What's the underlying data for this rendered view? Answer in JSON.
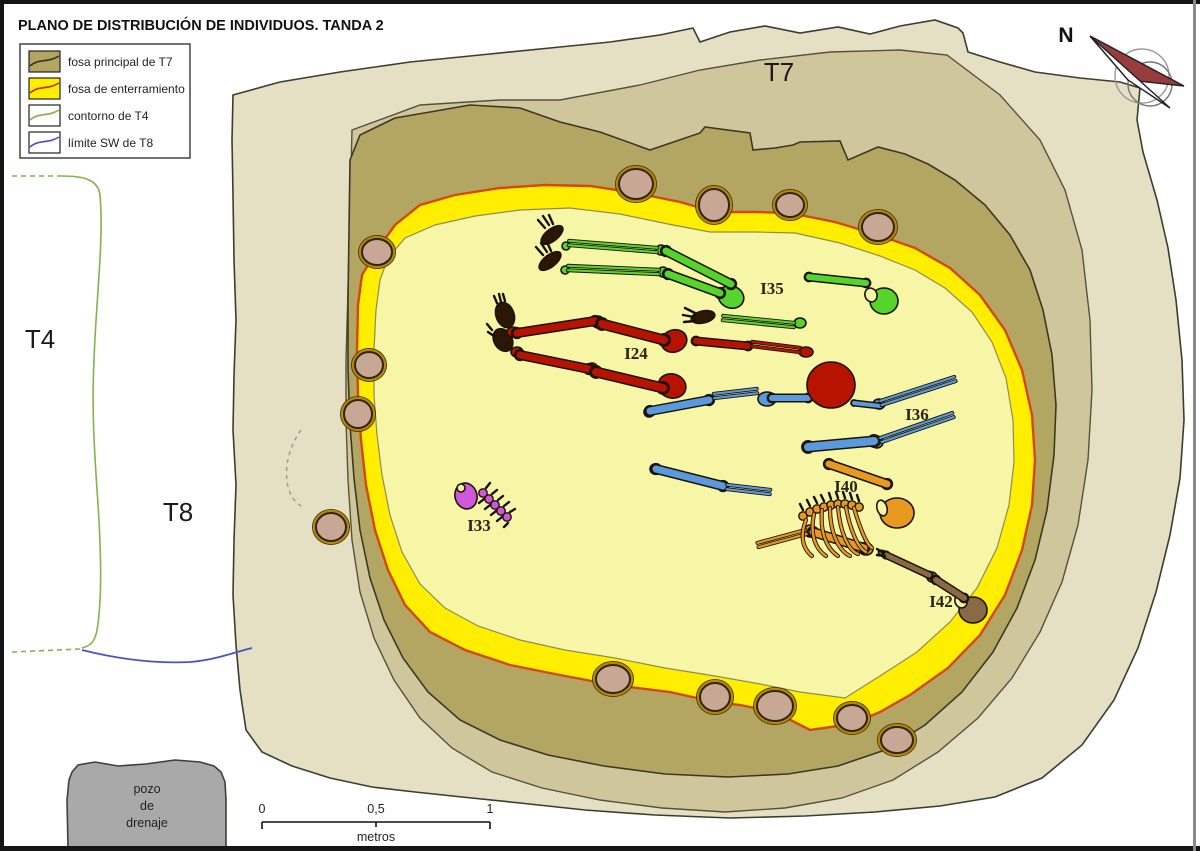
{
  "title": "PLANO DE DISTRIBUCIÓN DE INDIVIDUOS. TANDA 2",
  "legend": {
    "items": [
      {
        "label": "fosa principal de T7"
      },
      {
        "label": "fosa de enterramiento"
      },
      {
        "label": "contorno de T4"
      },
      {
        "label": "límite SW de T8"
      }
    ]
  },
  "area_labels": {
    "t7": "T7",
    "t4": "T4",
    "t8": "T8"
  },
  "north_label": "N",
  "pozo": {
    "line1": "pozo",
    "line2": "de",
    "line3": "drenaje"
  },
  "scale": {
    "t0": "0",
    "t05": "0,5",
    "t1": "1",
    "unit": "metros"
  },
  "colors": {
    "beige": "#e5e0c4",
    "medium": "#cfc79b",
    "olive": "#b2a662",
    "yellow": "#ffee00",
    "pit_inner": "#f7f6a6",
    "red_line": "#d4490b",
    "stone": "#c9a795",
    "stone_ring": "#b88600",
    "pozo": "#a9a9a9",
    "maroon": "#963c3c",
    "green_line": "#83b34c",
    "blue_line": "#4a52c8",
    "label_dark": "#2b2415",
    "flesh_dark": "#2c1606"
  },
  "stones": [
    [
      636,
      184,
      17,
      15
    ],
    [
      714,
      205,
      15,
      16
    ],
    [
      790,
      205,
      14,
      12
    ],
    [
      878,
      227,
      16,
      14
    ],
    [
      377,
      252,
      15,
      13
    ],
    [
      369,
      365,
      14,
      13
    ],
    [
      358,
      414,
      14,
      14
    ],
    [
      331,
      527,
      15,
      14
    ],
    [
      613,
      679,
      17,
      14
    ],
    [
      715,
      697,
      15,
      14
    ],
    [
      775,
      706,
      18,
      15
    ],
    [
      852,
      718,
      15,
      13
    ],
    [
      897,
      740,
      16,
      13
    ]
  ],
  "individuals": [
    {
      "id": "I35",
      "color": "#55d42b",
      "label": [
        772,
        294
      ],
      "bones": [
        [
          666,
          251,
          731,
          284,
          7
        ],
        [
          668,
          274,
          720,
          293,
          7
        ],
        [
          809,
          277,
          866,
          283,
          6
        ]
      ],
      "pairs": [
        [
          569,
          243,
          657,
          250
        ],
        [
          568,
          268,
          659,
          272
        ],
        [
          723,
          318,
          794,
          325
        ]
      ],
      "blobs": [
        [
          552,
          235,
          13,
          6,
          -38,
          "dark"
        ],
        [
          550,
          261,
          13,
          6,
          -38,
          "dark"
        ],
        [
          566,
          246,
          4,
          4,
          0,
          "self"
        ],
        [
          565,
          270,
          4,
          4,
          0,
          "self"
        ],
        [
          661,
          250,
          5,
          5,
          0,
          "self"
        ],
        [
          663,
          272,
          5,
          5,
          0,
          "self"
        ],
        [
          731,
          297,
          13,
          11,
          20,
          "self"
        ],
        [
          703,
          317,
          12,
          6,
          -12,
          "dark"
        ],
        [
          800,
          323,
          6,
          5,
          0,
          "self"
        ],
        [
          884,
          301,
          14,
          13,
          0,
          "self"
        ],
        [
          871,
          295,
          6,
          7,
          -20,
          "pale"
        ]
      ],
      "ticks": [
        [
          545,
          228,
          538,
          220
        ],
        [
          549,
          225,
          543,
          216
        ],
        [
          553,
          224,
          549,
          215
        ],
        [
          543,
          255,
          536,
          247
        ],
        [
          547,
          252,
          541,
          243
        ],
        [
          551,
          251,
          547,
          242
        ],
        [
          695,
          313,
          685,
          308
        ],
        [
          694,
          317,
          683,
          315
        ],
        [
          695,
          321,
          684,
          322
        ]
      ]
    },
    {
      "id": "I36",
      "color": "#5b99de",
      "label": [
        917,
        420
      ],
      "bones": [
        [
          650,
          411,
          709,
          400,
          7
        ],
        [
          772,
          398,
          808,
          398,
          6
        ],
        [
          854,
          403,
          880,
          406,
          4
        ],
        [
          808,
          447,
          874,
          441,
          8
        ],
        [
          656,
          469,
          723,
          486,
          7
        ]
      ],
      "pairs": [
        [
          714,
          396,
          757,
          391
        ],
        [
          881,
          403,
          955,
          379
        ],
        [
          881,
          440,
          953,
          415
        ],
        [
          727,
          487,
          770,
          492
        ]
      ],
      "blobs": [
        [
          649,
          412,
          5,
          5,
          0,
          "self"
        ],
        [
          767,
          399,
          9,
          7,
          0,
          "self"
        ],
        [
          877,
          442,
          6,
          6,
          0,
          "self"
        ],
        [
          879,
          404,
          6,
          5,
          0,
          "self"
        ],
        [
          655,
          469,
          5,
          5,
          0,
          "self"
        ]
      ],
      "ticks": []
    },
    {
      "id": "I24",
      "color": "#b81300",
      "label": [
        636,
        359
      ],
      "bones": [
        [
          517,
          333,
          595,
          321,
          7
        ],
        [
          602,
          324,
          664,
          340,
          8
        ],
        [
          520,
          355,
          589,
          369,
          7
        ],
        [
          596,
          372,
          663,
          388,
          8
        ],
        [
          696,
          341,
          748,
          346,
          6
        ]
      ],
      "pairs": [
        [
          752,
          344,
          800,
          350
        ]
      ],
      "blobs": [
        [
          505,
          315,
          13,
          9,
          70,
          "dark"
        ],
        [
          503,
          340,
          12,
          9,
          60,
          "dark"
        ],
        [
          513,
          332,
          6,
          5,
          0,
          "self"
        ],
        [
          517,
          352,
          6,
          5,
          0,
          "self"
        ],
        [
          598,
          322,
          6,
          6,
          0,
          "self"
        ],
        [
          592,
          369,
          6,
          6,
          0,
          "self"
        ],
        [
          674,
          341,
          13,
          11,
          -20,
          "self"
        ],
        [
          672,
          386,
          14,
          12,
          15,
          "self"
        ],
        [
          806,
          352,
          7,
          5,
          0,
          "self"
        ],
        [
          831,
          385,
          24,
          23,
          0,
          "self"
        ]
      ],
      "ticks": [
        [
          497,
          303,
          494,
          296
        ],
        [
          501,
          302,
          499,
          294
        ],
        [
          505,
          301,
          503,
          294
        ],
        [
          492,
          330,
          487,
          324
        ],
        [
          494,
          336,
          488,
          332
        ]
      ]
    },
    {
      "id": "I33",
      "color": "#cf57da",
      "label": [
        479,
        531
      ],
      "bones": [],
      "pairs": [],
      "blobs": [
        [
          466,
          496,
          11,
          13,
          -15,
          "self"
        ],
        [
          461,
          488,
          4,
          4,
          0,
          "pale"
        ]
      ],
      "verts": [
        [
          483,
          493
        ],
        [
          489,
          499
        ],
        [
          495,
          505
        ],
        [
          501,
          511
        ],
        [
          507,
          517
        ]
      ],
      "ticks": [
        [
          486,
          488,
          490,
          483
        ],
        [
          492,
          494,
          497,
          490
        ],
        [
          498,
          500,
          503,
          496
        ],
        [
          504,
          506,
          509,
          502
        ],
        [
          510,
          512,
          515,
          509
        ],
        [
          484,
          499,
          479,
          503
        ],
        [
          490,
          505,
          485,
          509
        ],
        [
          496,
          511,
          491,
          515
        ],
        [
          502,
          517,
          497,
          521
        ],
        [
          508,
          523,
          504,
          527
        ]
      ]
    },
    {
      "id": "I40",
      "color": "#e79a1f",
      "label": [
        846,
        492
      ],
      "bones": [
        [
          829,
          464,
          887,
          484,
          7
        ],
        [
          813,
          532,
          864,
          548,
          7
        ]
      ],
      "pairs": [
        [
          758,
          545,
          806,
          532
        ]
      ],
      "blobs": [
        [
          897,
          513,
          17,
          15,
          0,
          "self"
        ],
        [
          882,
          508,
          5,
          8,
          -15,
          "pale"
        ],
        [
          810,
          531,
          6,
          6,
          0,
          "self"
        ],
        [
          866,
          549,
          7,
          6,
          0,
          "self"
        ]
      ],
      "verts": [
        [
          803,
          516
        ],
        [
          810,
          512
        ],
        [
          817,
          509
        ],
        [
          824,
          507
        ],
        [
          831,
          505
        ],
        [
          838,
          504
        ],
        [
          845,
          504
        ],
        [
          852,
          505
        ],
        [
          859,
          507
        ]
      ],
      "ribs": [
        "M806,520 C800,535 802,548 812,556",
        "M814,514 C810,532 814,548 826,556",
        "M822,510 C820,532 826,548 838,556",
        "M830,508 C830,532 838,550 850,556",
        "M838,507 C840,532 848,550 858,554",
        "M846,507 C850,530 858,548 866,552",
        "M854,508 C860,528 866,544 872,548"
      ],
      "ticks": [
        [
          803,
          510,
          800,
          504
        ],
        [
          810,
          506,
          807,
          500
        ],
        [
          817,
          503,
          814,
          497
        ],
        [
          824,
          501,
          821,
          495
        ],
        [
          831,
          499,
          829,
          493
        ],
        [
          838,
          498,
          836,
          492
        ],
        [
          845,
          498,
          843,
          492
        ],
        [
          852,
          499,
          850,
          493
        ],
        [
          859,
          501,
          857,
          495
        ]
      ]
    },
    {
      "id": "I42",
      "color": "#8a6a45",
      "label": [
        941,
        607
      ],
      "bones": [
        [
          886,
          555,
          929,
          575,
          5
        ],
        [
          936,
          580,
          964,
          598,
          6
        ]
      ],
      "pairs": [],
      "blobs": [
        [
          884,
          554,
          6,
          3,
          25,
          "self"
        ],
        [
          932,
          577,
          5,
          5,
          0,
          "self"
        ],
        [
          973,
          610,
          14,
          13,
          0,
          "self"
        ],
        [
          961,
          601,
          6,
          7,
          -20,
          "pale"
        ]
      ],
      "ticks": [
        [
          884,
          553,
          877,
          549
        ],
        [
          885,
          556,
          877,
          555
        ]
      ]
    }
  ]
}
